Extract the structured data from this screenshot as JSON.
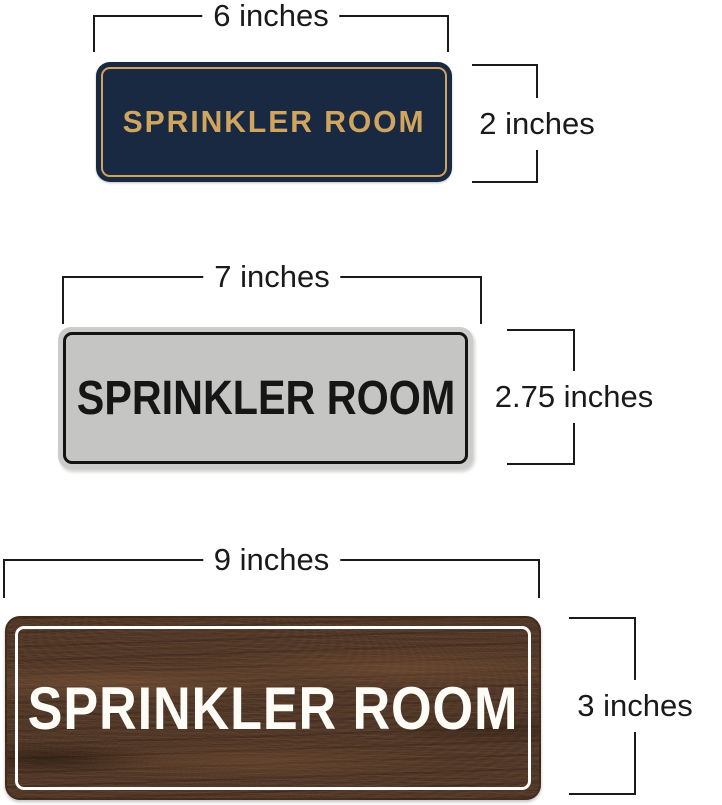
{
  "annotation": {
    "line_color": "#1a1a1a",
    "label_color": "#1a1a1a"
  },
  "signs": [
    {
      "style": "navy-gold",
      "text": "SPRINKLER ROOM",
      "width_label": "6 inches",
      "height_label": "2 inches",
      "colors": {
        "panel": "#1a2942",
        "border": "#cfa35c",
        "text": "#d0a55e"
      }
    },
    {
      "style": "silver-black",
      "text": "SPRINKLER ROOM",
      "width_label": "7 inches",
      "height_label": "2.75 inches",
      "colors": {
        "frame": "#cccdcb",
        "panel": "#c5c6c4",
        "border": "#141414",
        "text": "#161616"
      }
    },
    {
      "style": "walnut-white",
      "text": "SPRINKLER ROOM",
      "width_label": "9 inches",
      "height_label": "3 inches",
      "colors": {
        "panel": "#553b2a",
        "border": "#ffffff",
        "text": "#fdfcf7"
      }
    }
  ]
}
